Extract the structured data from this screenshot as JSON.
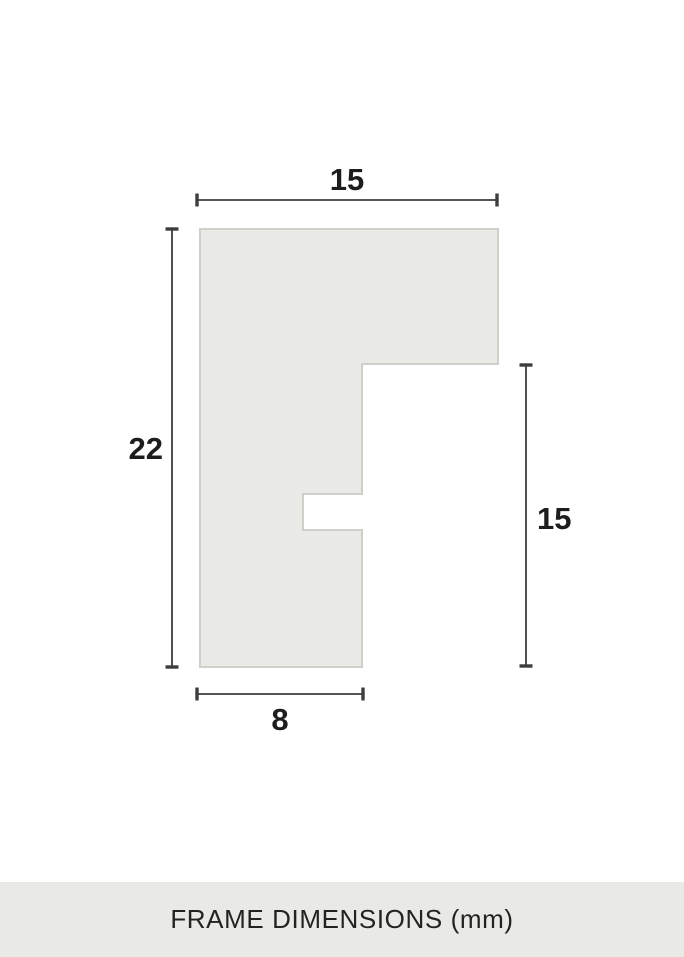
{
  "diagram": {
    "unit": "mm",
    "dimensions": {
      "top_width": "15",
      "left_height": "22",
      "right_height": "15",
      "bottom_width": "8"
    },
    "colors": {
      "shape_fill": "#e9e9e5",
      "shape_stroke": "#d0d0cb",
      "dimension_line": "#3d3d3d",
      "label_text": "#1d1d1d"
    }
  },
  "footer": {
    "label": "FRAME DIMENSIONS (mm)",
    "background": "#e9e9e5",
    "text_color": "#232323"
  }
}
